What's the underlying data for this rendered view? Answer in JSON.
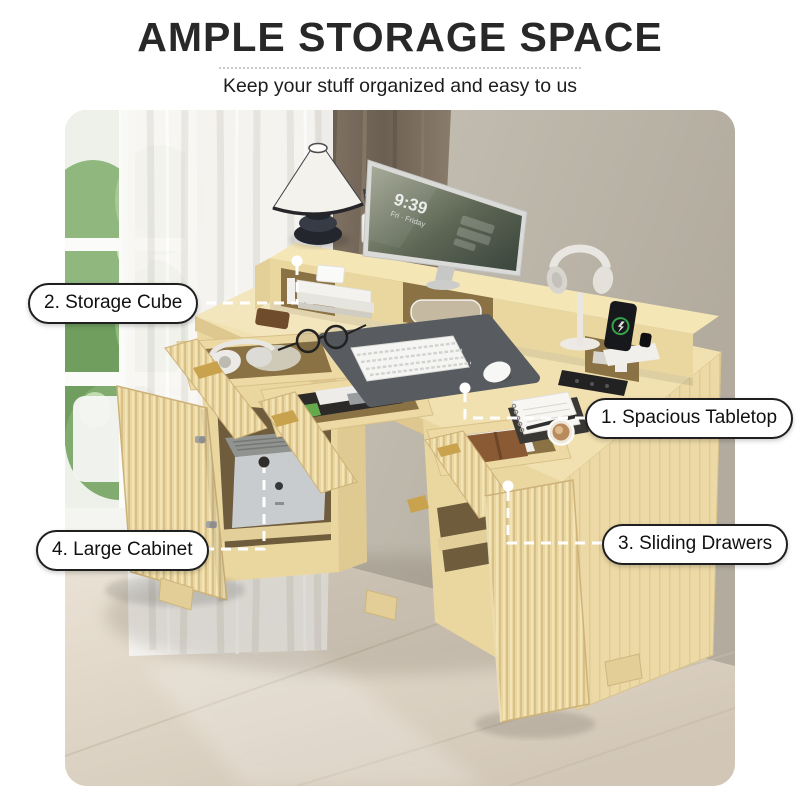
{
  "header": {
    "title": "AMPLE STORAGE SPACE",
    "subtitle": "Keep your stuff organized and easy to us"
  },
  "callouts": {
    "spacious_tabletop": {
      "label": "1. Spacious Tabletop"
    },
    "storage_cube": {
      "label": "2. Storage Cube"
    },
    "sliding_drawers": {
      "label": "3. Sliding Drawers"
    },
    "large_cabinet": {
      "label": "4. Large Cabinet"
    }
  },
  "photo": {
    "monitor": {
      "time": "9:39",
      "date": "Fri · Friday"
    },
    "colors": {
      "wood_top": "#f1e1b0",
      "wood_mid": "#ead7a0",
      "wood_deep": "#dfc88f",
      "wood_interior": "#8a7245",
      "gold": "#c9a24e",
      "wall": "#c9c4b9",
      "curtain_brown": "#776a5b",
      "floor": "#ddd3c5",
      "pad": "#585c60",
      "ink": "#1f1f1f",
      "line": "#ffffff"
    }
  }
}
